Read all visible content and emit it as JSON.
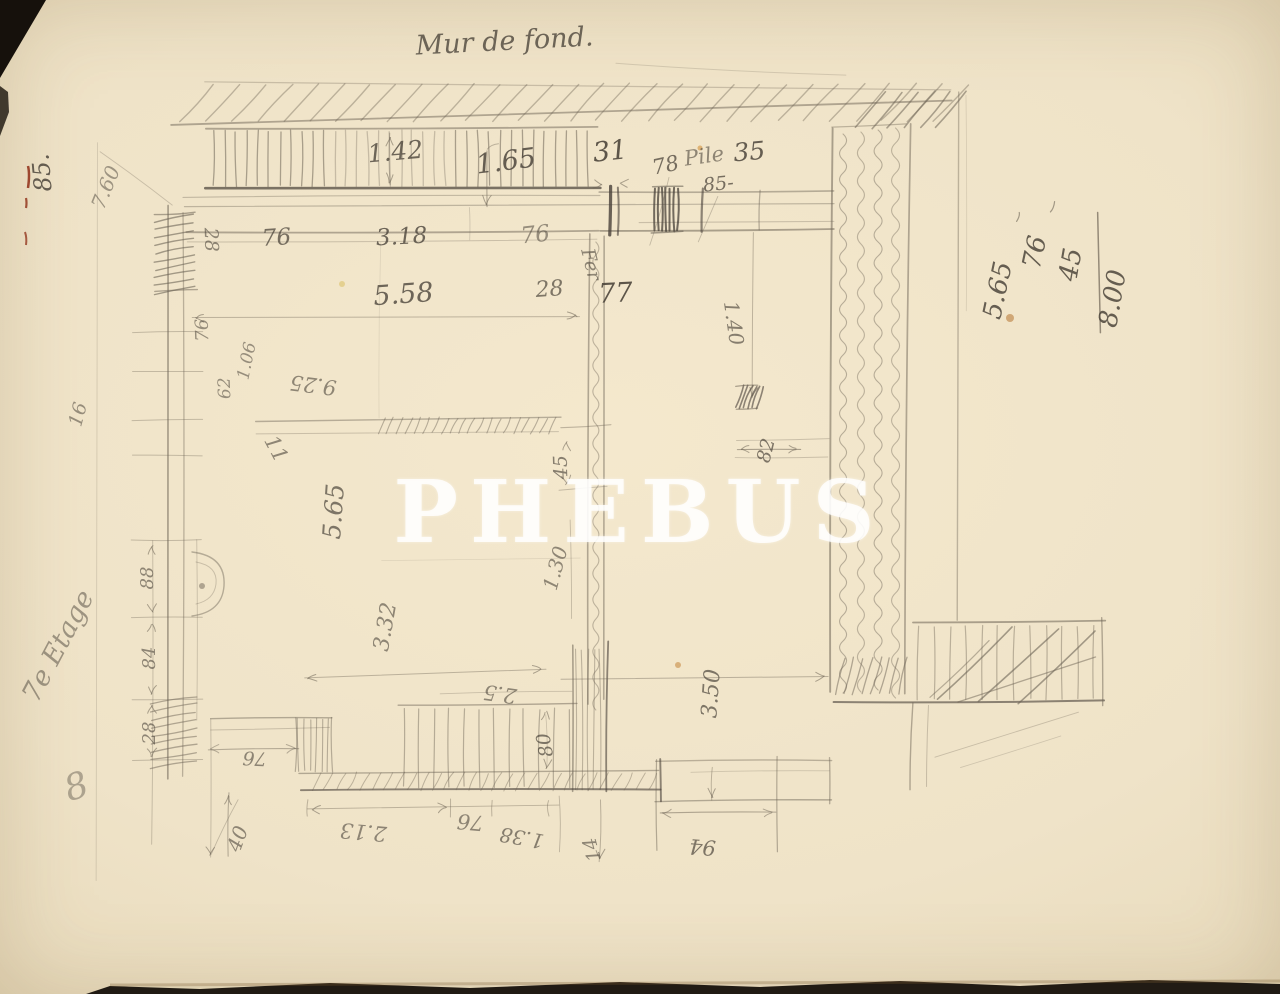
{
  "watermark": {
    "text": "PHEBUS"
  },
  "colors": {
    "paper": "#efe3c8",
    "pencil": "#6d6456",
    "dark_pencil": "#474038",
    "watermark": "#ffffff",
    "red_ink": "#8f2d15",
    "photo_border": "#16110c"
  },
  "annotations": [
    {
      "name": "sketch-title",
      "text": "Mur de fond.",
      "x": 505,
      "y": 50,
      "rot": -3,
      "size": 27,
      "opacity": 0.8
    },
    {
      "name": "corner-number",
      "text": "85.",
      "x": 50,
      "y": 172,
      "rot": -95,
      "size": 24,
      "opacity": 0.85
    },
    {
      "text": "7.60",
      "x": 112,
      "y": 190,
      "rot": -68,
      "size": 20,
      "opacity": 0.5
    },
    {
      "text": "1.42",
      "x": 396,
      "y": 160,
      "rot": -5,
      "size": 25,
      "opacity": 0.8
    },
    {
      "text": "1.65",
      "x": 507,
      "y": 170,
      "rot": -7,
      "size": 27,
      "opacity": 0.85
    },
    {
      "text": "31",
      "x": 611,
      "y": 160,
      "rot": -6,
      "size": 27,
      "opacity": 0.9
    },
    {
      "text": "78",
      "x": 667,
      "y": 172,
      "rot": -12,
      "size": 21,
      "opacity": 0.75
    },
    {
      "name": "pile-note",
      "text": "Pile",
      "x": 705,
      "y": 163,
      "rot": -8,
      "size": 21,
      "opacity": 0.6
    },
    {
      "text": "85-",
      "x": 719,
      "y": 190,
      "rot": -6,
      "size": 19,
      "opacity": 0.75
    },
    {
      "text": "35",
      "x": 750,
      "y": 160,
      "rot": -5,
      "size": 25,
      "opacity": 0.85
    },
    {
      "text": "28",
      "x": 205,
      "y": 240,
      "rot": 88,
      "size": 19,
      "opacity": 0.6
    },
    {
      "text": "76",
      "x": 277,
      "y": 245,
      "rot": -4,
      "size": 23,
      "opacity": 0.75
    },
    {
      "text": "3.18",
      "x": 402,
      "y": 244,
      "rot": -3,
      "size": 23,
      "opacity": 0.8
    },
    {
      "text": "76",
      "x": 536,
      "y": 242,
      "rot": -6,
      "size": 23,
      "opacity": 0.55
    },
    {
      "text": "5.58",
      "x": 404,
      "y": 303,
      "rot": -4,
      "size": 27,
      "opacity": 0.8
    },
    {
      "text": "28",
      "x": 550,
      "y": 296,
      "rot": -4,
      "size": 22,
      "opacity": 0.7
    },
    {
      "text": "77",
      "x": 616,
      "y": 302,
      "rot": -3,
      "size": 27,
      "opacity": 0.9
    },
    {
      "name": "fer-note",
      "text": "Fer",
      "x": 585,
      "y": 266,
      "rot": 76,
      "size": 19,
      "opacity": 0.6
    },
    {
      "text": "1.40",
      "x": 727,
      "y": 324,
      "rot": 82,
      "size": 20,
      "opacity": 0.65
    },
    {
      "text": "9.25",
      "x": 314,
      "y": 378,
      "rot": 187,
      "size": 21,
      "opacity": 0.6
    },
    {
      "text": "76",
      "x": 208,
      "y": 330,
      "rot": -92,
      "size": 18,
      "opacity": 0.55
    },
    {
      "text": "62",
      "x": 230,
      "y": 388,
      "rot": -92,
      "size": 17,
      "opacity": 0.55
    },
    {
      "text": "1.06",
      "x": 252,
      "y": 362,
      "rot": -78,
      "size": 17,
      "opacity": 0.55
    },
    {
      "text": "16",
      "x": 84,
      "y": 416,
      "rot": -75,
      "size": 19,
      "opacity": 0.55
    },
    {
      "text": "11",
      "x": 270,
      "y": 452,
      "rot": 62,
      "size": 21,
      "opacity": 0.6
    },
    {
      "text": "45",
      "x": 567,
      "y": 467,
      "rot": -92,
      "size": 19,
      "opacity": 0.65
    },
    {
      "text": "1.30",
      "x": 562,
      "y": 570,
      "rot": -75,
      "size": 20,
      "opacity": 0.6
    },
    {
      "text": "5.65",
      "x": 342,
      "y": 512,
      "rot": -86,
      "size": 25,
      "opacity": 0.7
    },
    {
      "text": "3.32",
      "x": 392,
      "y": 628,
      "rot": -80,
      "size": 22,
      "opacity": 0.6
    },
    {
      "text": "82",
      "x": 772,
      "y": 452,
      "rot": -76,
      "size": 19,
      "opacity": 0.7
    },
    {
      "text": "88",
      "x": 153,
      "y": 578,
      "rot": -90,
      "size": 18,
      "opacity": 0.6
    },
    {
      "text": "84",
      "x": 155,
      "y": 658,
      "rot": -90,
      "size": 18,
      "opacity": 0.6
    },
    {
      "text": "28",
      "x": 155,
      "y": 733,
      "rot": -90,
      "size": 18,
      "opacity": 0.6
    },
    {
      "text": "76",
      "x": 255,
      "y": 752,
      "rot": 183,
      "size": 19,
      "opacity": 0.6
    },
    {
      "text": "2.5",
      "x": 501,
      "y": 687,
      "rot": 188,
      "size": 21,
      "opacity": 0.6
    },
    {
      "text": "80",
      "x": 551,
      "y": 744,
      "rot": -100,
      "size": 19,
      "opacity": 0.7
    },
    {
      "text": "3.50",
      "x": 718,
      "y": 694,
      "rot": -86,
      "size": 22,
      "opacity": 0.7
    },
    {
      "text": "40",
      "x": 244,
      "y": 841,
      "rot": -70,
      "size": 20,
      "opacity": 0.6
    },
    {
      "text": "2.13",
      "x": 364,
      "y": 825,
      "rot": 185,
      "size": 21,
      "opacity": 0.6
    },
    {
      "text": "76",
      "x": 471,
      "y": 815,
      "rot": 185,
      "size": 21,
      "opacity": 0.6
    },
    {
      "text": "1.38",
      "x": 523,
      "y": 831,
      "rot": 190,
      "size": 20,
      "opacity": 0.65
    },
    {
      "text": "14",
      "x": 598,
      "y": 848,
      "rot": -105,
      "size": 19,
      "opacity": 0.6
    },
    {
      "text": "94",
      "x": 703,
      "y": 840,
      "rot": 184,
      "size": 21,
      "opacity": 0.7
    },
    {
      "name": "calc-value-1",
      "text": "5.65",
      "x": 1006,
      "y": 292,
      "rot": -78,
      "size": 26,
      "opacity": 0.85
    },
    {
      "name": "calc-value-2",
      "text": "76",
      "x": 1043,
      "y": 254,
      "rot": -78,
      "size": 26,
      "opacity": 0.85
    },
    {
      "name": "calc-value-3",
      "text": "45",
      "x": 1079,
      "y": 266,
      "rot": -80,
      "size": 26,
      "opacity": 0.85
    },
    {
      "name": "calc-total",
      "text": "8.00",
      "x": 1121,
      "y": 300,
      "rot": -80,
      "size": 26,
      "opacity": 0.85
    },
    {
      "name": "floor-label",
      "text": "7e Etage",
      "x": 66,
      "y": 650,
      "rot": -62,
      "size": 27,
      "opacity": 0.5
    },
    {
      "name": "margin-mark",
      "text": "8",
      "x": 80,
      "y": 798,
      "rot": -18,
      "size": 36,
      "opacity": 0.4
    }
  ]
}
